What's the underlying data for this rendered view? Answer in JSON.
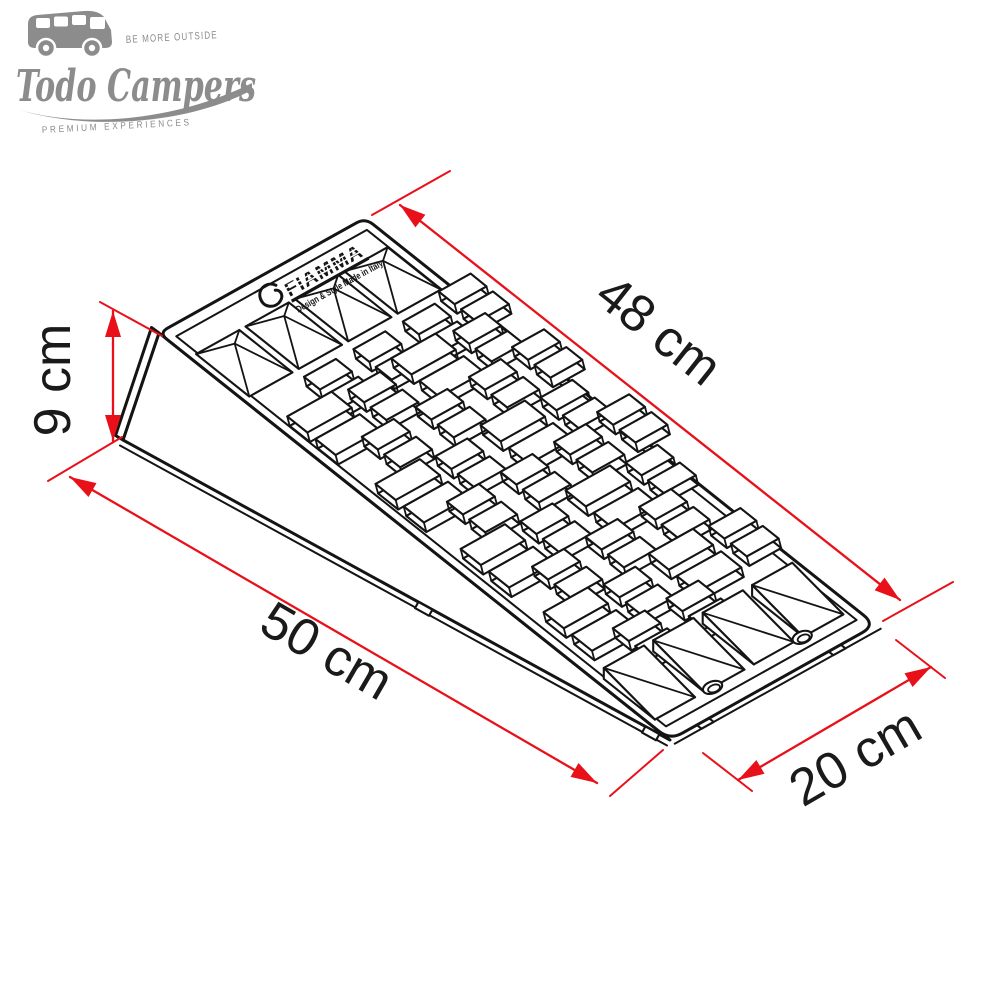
{
  "page": {
    "background": "#ffffff"
  },
  "branding": {
    "color": "#8c8c8c",
    "tagline_top": "BE MORE OUTSIDE",
    "name": "Todo Campers",
    "tagline_bottom": "PREMIUM EXPERIENCES"
  },
  "product_marking": {
    "brand": "FIAMMA",
    "tagline": "Design & Style Made in Italy"
  },
  "annotations": {
    "accent_color": "#e8111a",
    "label_color": "#1a1a1a",
    "line_color": "#141414",
    "labels": {
      "slope_length": "48 cm",
      "height": "9 cm",
      "base_length": "50 cm",
      "width": "20 cm"
    }
  }
}
